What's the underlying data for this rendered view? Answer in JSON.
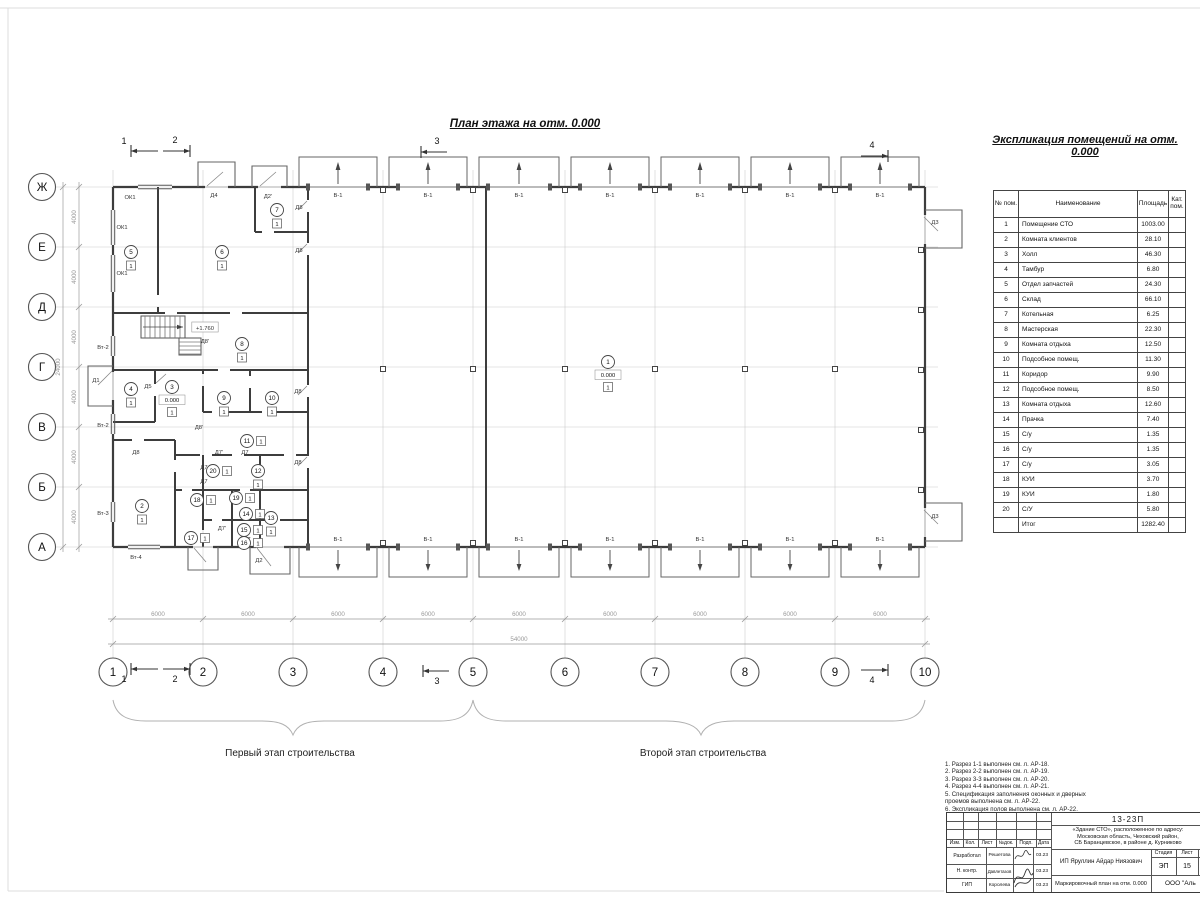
{
  "page": {
    "bg": "#ffffff",
    "line_color": "#3d3d3d",
    "grid_color": "#cccccc",
    "dim_color": "#9a9a9a"
  },
  "plan": {
    "title": "План этажа на отм. 0.000",
    "stage1_label": "Первый этап строительства",
    "stage2_label": "Второй этап строительства",
    "gate_label": "В-1",
    "dim_bay": "6000",
    "dim_total_bottom": "54000",
    "dim_seg_left": "4000",
    "dim_total_left": "24000",
    "axes_numbers": [
      {
        "label": "1",
        "x": 113
      },
      {
        "label": "2",
        "x": 203
      },
      {
        "label": "3",
        "x": 293
      },
      {
        "label": "4",
        "x": 383
      },
      {
        "label": "5",
        "x": 473
      },
      {
        "label": "6",
        "x": 565
      },
      {
        "label": "7",
        "x": 655
      },
      {
        "label": "8",
        "x": 745
      },
      {
        "label": "9",
        "x": 835
      },
      {
        "label": "10",
        "x": 925
      }
    ],
    "axes_letters": [
      {
        "label": "Ж",
        "y": 187
      },
      {
        "label": "Е",
        "y": 247
      },
      {
        "label": "Д",
        "y": 307
      },
      {
        "label": "Г",
        "y": 367
      },
      {
        "label": "В",
        "y": 427
      },
      {
        "label": "Б",
        "y": 487
      },
      {
        "label": "А",
        "y": 547
      }
    ],
    "section_marks": [
      {
        "label": "1",
        "tail": 158,
        "head": 131,
        "y": 151,
        "tx": 124,
        "ty": 144
      },
      {
        "label": "2",
        "tail": 163,
        "head": 190,
        "y": 151,
        "tx": 175,
        "ty": 143
      },
      {
        "label": "3",
        "tail": 447,
        "head": 421,
        "y": 152,
        "tx": 437,
        "ty": 144
      },
      {
        "label": "4",
        "tail": 861,
        "head": 888,
        "y": 156,
        "tx": 872,
        "ty": 148
      },
      {
        "label": "1",
        "tail": 158,
        "head": 131,
        "y": 669,
        "tx": 124,
        "ty": 682
      },
      {
        "label": "2",
        "tail": 163,
        "head": 190,
        "y": 669,
        "tx": 175,
        "ty": 682
      },
      {
        "label": "3",
        "tail": 449,
        "head": 423,
        "y": 671,
        "tx": 437,
        "ty": 684
      },
      {
        "label": "4",
        "tail": 861,
        "head": 888,
        "y": 670,
        "tx": 872,
        "ty": 683
      }
    ],
    "labels": [
      {
        "t": "ОК1",
        "x": 130,
        "y": 197
      },
      {
        "t": "ОК1",
        "x": 122,
        "y": 227
      },
      {
        "t": "ОК1",
        "x": 122,
        "y": 273
      },
      {
        "t": "Д4",
        "x": 214,
        "y": 195
      },
      {
        "t": "Д2'",
        "x": 268,
        "y": 196
      },
      {
        "t": "Д8",
        "x": 299,
        "y": 207
      },
      {
        "t": "Д8",
        "x": 299,
        "y": 250
      },
      {
        "t": "Д8",
        "x": 298,
        "y": 391
      },
      {
        "t": "Д8",
        "x": 298,
        "y": 462
      },
      {
        "t": "Д8",
        "x": 136,
        "y": 452
      },
      {
        "t": "Д8'",
        "x": 205,
        "y": 341
      },
      {
        "t": "Д8'",
        "x": 199,
        "y": 427
      },
      {
        "t": "Д1",
        "x": 96,
        "y": 380
      },
      {
        "t": "Д5",
        "x": 148,
        "y": 386
      },
      {
        "t": "Д2",
        "x": 259,
        "y": 560
      },
      {
        "t": "Вт-4",
        "x": 136,
        "y": 557
      },
      {
        "t": "Д3",
        "x": 935,
        "y": 222
      },
      {
        "t": "Д3",
        "x": 935,
        "y": 516
      },
      {
        "t": "Вт-2",
        "x": 103,
        "y": 347
      },
      {
        "t": "Вт-2",
        "x": 103,
        "y": 425
      },
      {
        "t": "Вт-3",
        "x": 103,
        "y": 513
      },
      {
        "t": "Д7'",
        "x": 219,
        "y": 452
      },
      {
        "t": "Д7",
        "x": 245,
        "y": 452
      },
      {
        "t": "Д7",
        "x": 204,
        "y": 467
      },
      {
        "t": "Д7",
        "x": 204,
        "y": 481
      },
      {
        "t": "Д7'",
        "x": 222,
        "y": 528
      },
      {
        "t": "Д7",
        "x": 247,
        "y": 539
      },
      {
        "t": "+1.760",
        "x": 205,
        "y": 328,
        "box": true
      }
    ],
    "room_markers": [
      {
        "n": "1",
        "x": 608,
        "y": 362,
        "level": "0.000",
        "floor": "1",
        "fs": "b"
      },
      {
        "n": "2",
        "x": 142,
        "y": 506,
        "floor": "1",
        "fs": "b"
      },
      {
        "n": "3",
        "x": 172,
        "y": 387,
        "level": "0.000",
        "floor": "1",
        "fs": "b"
      },
      {
        "n": "4",
        "x": 131,
        "y": 389,
        "floor": "1",
        "fs": "b"
      },
      {
        "n": "5",
        "x": 131,
        "y": 252,
        "floor": "1",
        "fs": "b"
      },
      {
        "n": "6",
        "x": 222,
        "y": 252,
        "floor": "1",
        "fs": "b"
      },
      {
        "n": "7",
        "x": 277,
        "y": 210,
        "floor": "1",
        "fs": "b"
      },
      {
        "n": "8",
        "x": 242,
        "y": 344,
        "floor": "1",
        "fs": "b"
      },
      {
        "n": "9",
        "x": 224,
        "y": 398,
        "floor": "1",
        "fs": "b"
      },
      {
        "n": "10",
        "x": 272,
        "y": 398,
        "floor": "1",
        "fs": "b"
      },
      {
        "n": "11",
        "x": 247,
        "y": 441,
        "floor": "1",
        "fs": "r"
      },
      {
        "n": "12",
        "x": 258,
        "y": 471,
        "floor": "1",
        "fs": "b"
      },
      {
        "n": "13",
        "x": 271,
        "y": 518,
        "floor": "1",
        "fs": "b"
      },
      {
        "n": "14",
        "x": 246,
        "y": 514,
        "floor": "1",
        "fs": "r"
      },
      {
        "n": "15",
        "x": 244,
        "y": 530,
        "floor": "1",
        "fs": "r"
      },
      {
        "n": "16",
        "x": 244,
        "y": 543,
        "floor": "1",
        "fs": "r"
      },
      {
        "n": "17",
        "x": 191,
        "y": 538,
        "floor": "1",
        "fs": "r"
      },
      {
        "n": "18",
        "x": 197,
        "y": 500,
        "floor": "1",
        "fs": "r"
      },
      {
        "n": "19",
        "x": 236,
        "y": 498,
        "floor": "1",
        "fs": "r"
      },
      {
        "n": "20",
        "x": 213,
        "y": 471,
        "floor": "1",
        "fs": "r"
      }
    ],
    "columns": {
      "hall": {
        "y": 369,
        "xs": [
          383,
          473,
          565,
          655,
          745,
          835
        ]
      },
      "top": {
        "y": 190,
        "xs": [
          383,
          473,
          565,
          655,
          745,
          835
        ]
      },
      "bottom": {
        "y": 543,
        "xs": [
          383,
          473,
          565,
          655,
          745,
          835
        ]
      },
      "right": {
        "x": 921,
        "ys": [
          250,
          310,
          370,
          430,
          490
        ]
      }
    }
  },
  "explication": {
    "title": "Экспликация помещений на отм. 0.000",
    "headers": [
      "№ пом.",
      "Наименование",
      "Площадь",
      "Кат. пом."
    ],
    "rows": [
      [
        "1",
        "Помещение СТО",
        "1003.00",
        ""
      ],
      [
        "2",
        "Комната клиентов",
        "28.10",
        ""
      ],
      [
        "3",
        "Холл",
        "46.30",
        ""
      ],
      [
        "4",
        "Тамбур",
        "6.80",
        ""
      ],
      [
        "5",
        "Отдел запчастей",
        "24.30",
        ""
      ],
      [
        "6",
        "Склад",
        "66.10",
        ""
      ],
      [
        "7",
        "Котельная",
        "6.25",
        ""
      ],
      [
        "8",
        "Мастерская",
        "22.30",
        ""
      ],
      [
        "9",
        "Комната отдыха",
        "12.50",
        ""
      ],
      [
        "10",
        "Подсобное помещ.",
        "11.30",
        ""
      ],
      [
        "11",
        "Коридор",
        "9.90",
        ""
      ],
      [
        "12",
        "Подсобное помещ.",
        "8.50",
        ""
      ],
      [
        "13",
        "Комната отдыха",
        "12.60",
        ""
      ],
      [
        "14",
        "Прачка",
        "7.40",
        ""
      ],
      [
        "15",
        "С/у",
        "1.35",
        ""
      ],
      [
        "16",
        "С/у",
        "1.35",
        ""
      ],
      [
        "17",
        "С/у",
        "3.05",
        ""
      ],
      [
        "18",
        "КУИ",
        "3.70",
        ""
      ],
      [
        "19",
        "КУИ",
        "1.80",
        ""
      ],
      [
        "20",
        "С/У",
        "5.80",
        ""
      ]
    ],
    "total_label": "Итог",
    "total_value": "1282.40"
  },
  "notes": [
    "1. Разрез 1-1 выполнен см. л. АР-18.",
    "2. Разрез 2-2 выполнен см. л. АР-19.",
    "3. Разрез 3-3 выполнен см. л. АР-20.",
    "4. Разрез 4-4 выполнен см. л. АР-21.",
    "5. Спецификация заполнения оконных и дверных\n    проемов выполнена см. л. АР-22.",
    "6. Экспликация полов выполнена см. л. АР-22."
  ],
  "titleblock": {
    "doc_number": "13-23П",
    "project": "«Здание СТО», расположенное по адресу:\nМосковская область, Чеховский район,\nСБ Баранцевское, в районе д. Курниково",
    "client": "ИП Яруллин Айдар Ниязович",
    "sheet_title": "Маркировочный план на отм. 0.000",
    "company": "ООО \"Аль",
    "stage_label": "Стадия",
    "sheet_label": "Лист",
    "stage": "ЭП",
    "sheet": "15",
    "cols": [
      "Изм.",
      "Кол.",
      "Лист",
      "№док.",
      "Подп.",
      "Дата"
    ],
    "rows": [
      {
        "role": "Разработал",
        "name": "Решетова",
        "date": "03.23"
      },
      {
        "role": "Н. контр.",
        "name": "Давлетазов",
        "date": "03.23"
      },
      {
        "role": "ГИП",
        "name": "Королева",
        "date": "03.23"
      }
    ]
  }
}
